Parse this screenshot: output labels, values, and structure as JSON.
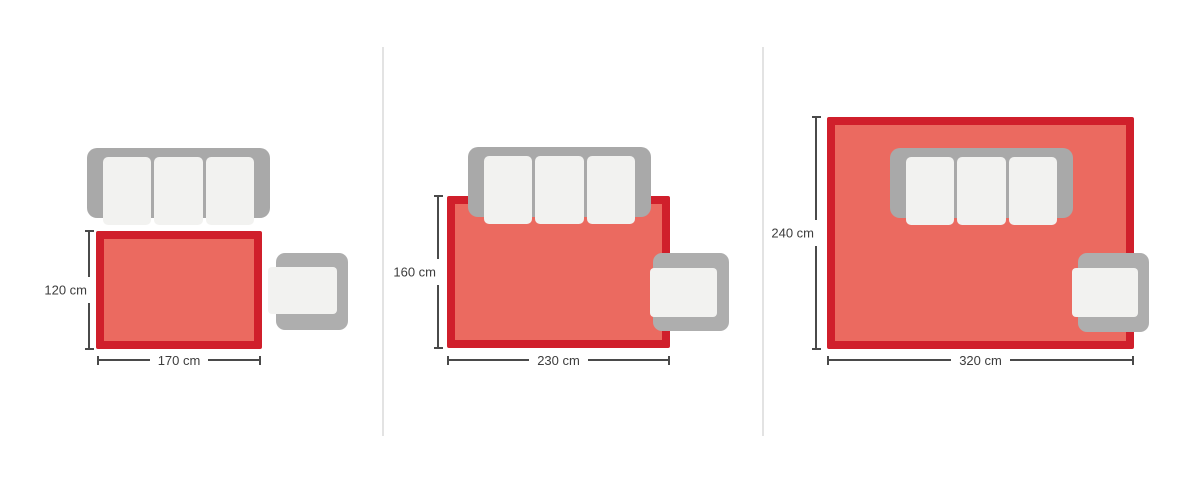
{
  "colors": {
    "rug_border": "#d01f2b",
    "rug_fill": "#eb6a60",
    "sofa_body": "#a9a9a9",
    "cushion": "#f2f2f0",
    "chair_body": "#aeaeae",
    "dim": "#4a4a4a",
    "text": "#3d3d3d",
    "divider": "#e3e3e3",
    "bg": "#ffffff"
  },
  "panels": [
    {
      "name": "rug-170x120",
      "rug_width_cm": 170,
      "rug_height_cm": 120,
      "width_label": "170 cm",
      "height_label": "120 cm"
    },
    {
      "name": "rug-230x160",
      "rug_width_cm": 230,
      "rug_height_cm": 160,
      "width_label": "230 cm",
      "height_label": "160 cm"
    },
    {
      "name": "rug-320x240",
      "rug_width_cm": 320,
      "rug_height_cm": 240,
      "width_label": "320 cm",
      "height_label": "240 cm"
    }
  ]
}
